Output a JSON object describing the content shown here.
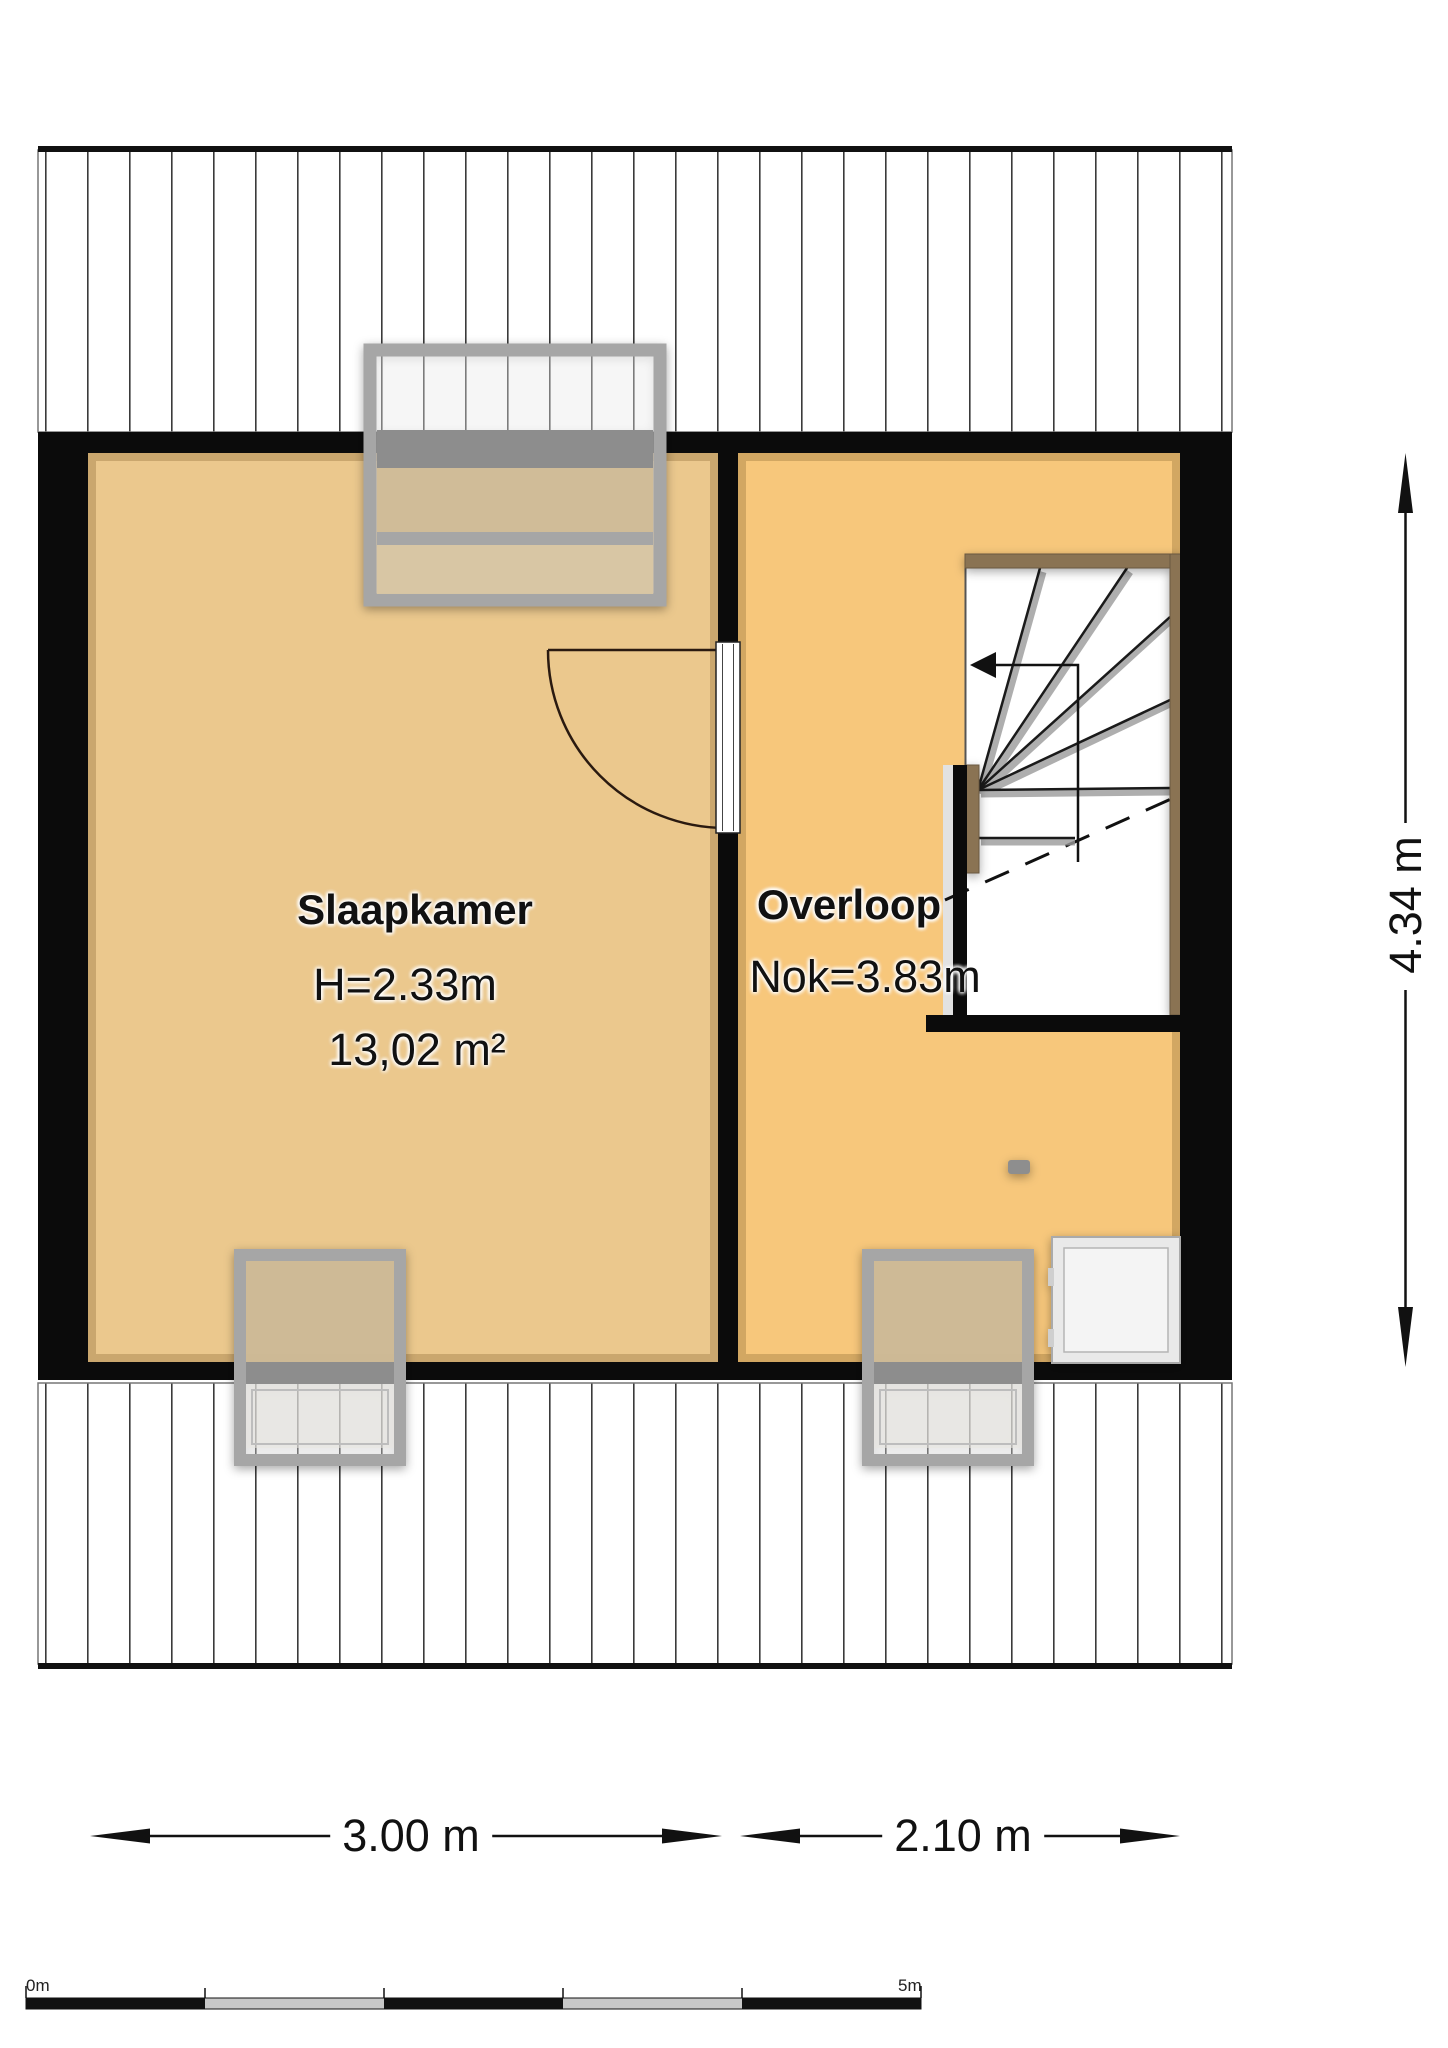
{
  "plan_title": "attic-floorplan",
  "rooms": {
    "bedroom": {
      "name": "Slaapkamer",
      "ceiling": "H=2.33m",
      "area": "13,02 m²"
    },
    "landing": {
      "name": "Overloop",
      "ridge": "Nok=3.83m"
    }
  },
  "dimensions": {
    "bedroom_width": "3.00 m",
    "landing_width": "2.10 m",
    "total_depth": "4.34 m"
  },
  "scale_bar": {
    "start_label": "0m",
    "end_label": "5m"
  },
  "colors": {
    "floor-bedroom": "#ebc88d",
    "floor-landing": "#f7c77b",
    "wall": "#0b0b0b",
    "hatchline": "#3a3a3a",
    "wood": "#8a7352",
    "skyframe": "#a6a6a6",
    "skyband": "#8d8d8d",
    "circle": "#9c9c9c",
    "boxfill": "#e9e9e9"
  }
}
